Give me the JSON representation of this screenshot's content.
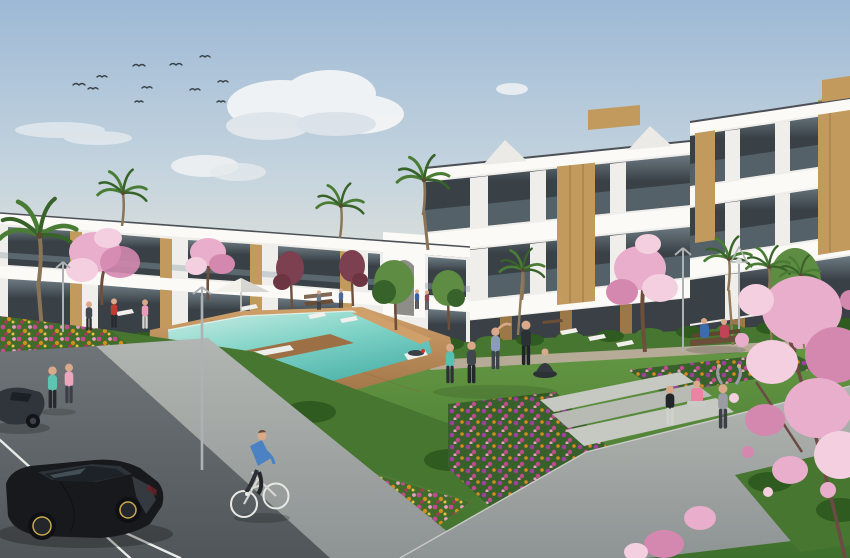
{
  "meta": {
    "type": "architectural-render",
    "subject": "New-build white apartment complex with communal swimming pool, lawns, flower beds, parking and residents outdoors",
    "width_px": 850,
    "height_px": 558
  },
  "colors": {
    "sky_top": "#9db9d5",
    "sky_mid": "#c3d3de",
    "sky_horizon": "#e5e4da",
    "cloud": "#f3f5f6",
    "bird": "#3a4248",
    "building_white": "#f0eeea",
    "building_slab": "#fbfaf7",
    "building_shadow": "#d9d7d2",
    "roof_edge": "#4b5056",
    "glass_dark": "#394147",
    "glass_light": "#6d7a82",
    "wood": "#c29a5e",
    "wood_dark": "#9c7848",
    "lawn_light": "#679a45",
    "lawn_dark": "#3f6f2c",
    "hedge": "#46762f",
    "hedge_dark": "#2f5a20",
    "pool_light": "#cdeee6",
    "pool_mid": "#7fd2c6",
    "pool_deep": "#49b0a8",
    "deck_light": "#cfa06a",
    "deck_dark": "#9c7044",
    "path_light": "#b2b6b2",
    "path_dark": "#8e9494",
    "walkway_light": "#aeb2ae",
    "step": "#c6c8c2",
    "asphalt_light": "#6e7478",
    "asphalt_dark": "#505659",
    "parking_line": "#e9ebe8",
    "car_black": "#17191c",
    "car_black_highlight": "#3c4248",
    "car_gray": "#2f353a",
    "rim_gold": "#c9a94c",
    "blossom": "#e9aecb",
    "blossom_light": "#f4cfe0",
    "blossom_deep": "#d488b0",
    "maroon_tree": "#7c4050",
    "palm_green": "#4a7c36",
    "palm_dark": "#37622a",
    "tree_green": "#5d8c42",
    "trunk": "#6d4f3c",
    "flower_magenta": "#c4498e",
    "flower_orange": "#d8891f",
    "flower_pink": "#e79ec0",
    "flower_red": "#b03558",
    "flower_violet": "#a040a0",
    "flower_yellow": "#e8c048",
    "skin": "#d9a98a",
    "lounger": "#f1f0ec",
    "lamp": "#aeb2b4",
    "bench_wood": "#6b4e38"
  },
  "inventory": {
    "birds": 11,
    "cloud_groups": 4,
    "apartment_wings": 3,
    "palm_trees": 8,
    "pink_blossom_trees": 4,
    "maroon_trees": 2,
    "green_trees": 3,
    "lamp_posts": 4,
    "benches": 3,
    "sun_loungers": 9,
    "parasols": 1,
    "pools": 1,
    "cars": 2,
    "bicycles": 1,
    "people": [
      {
        "label": "walker-teal-top",
        "shirt": "#5ec4b2",
        "pants": "#26292d"
      },
      {
        "label": "walker-pink-top",
        "shirt": "#eba7bd",
        "pants": "#3c4046"
      },
      {
        "label": "poolside-dark-jacket",
        "shirt": "#41484f",
        "pants": "#2a2d31"
      },
      {
        "label": "poolside-red-top",
        "shirt": "#c23b31",
        "pants": "#26292d"
      },
      {
        "label": "poolside-pink-top",
        "shirt": "#ec9cb8",
        "pants": "#d9d5cf"
      },
      {
        "label": "yoga-teal-top",
        "shirt": "#58c0b2",
        "pants": "#2c3036"
      },
      {
        "label": "yoga-dark",
        "shirt": "#40474e",
        "pants": "#23262a"
      },
      {
        "label": "yoga-stretching",
        "shirt": "#8b9cba",
        "pants": "#3c434a"
      },
      {
        "label": "yoga-black",
        "shirt": "#2c3135",
        "pants": "#202327"
      },
      {
        "label": "meditating-seated",
        "shirt": "#32383e",
        "pants": "#2c3136"
      },
      {
        "label": "standing-black-top-white-leggings",
        "shirt": "#232629",
        "pants": "#cfd1cd"
      },
      {
        "label": "sitting-pink-top-on-step",
        "shirt": "#ee82a2",
        "pants": "#c9cbc7"
      },
      {
        "label": "arms-raised-grey-hoodie",
        "shirt": "#9b9ba4",
        "pants": "#3c4046"
      },
      {
        "label": "person-on-sun-lounger",
        "shirt": "#3a4046",
        "pants": "#3a4046"
      },
      {
        "label": "cyclist-blue-shirt",
        "shirt": "#4a82c4",
        "pants": "#2c3136"
      },
      {
        "label": "bench-pair-blue",
        "shirt": "#3e6bb0",
        "pants": "#2a2e33"
      },
      {
        "label": "bench-pair-red",
        "shirt": "#c04458",
        "pants": "#2a2e33"
      },
      {
        "label": "distant-pedestrians",
        "shirt": "#3a60a8",
        "pants": "#8a4a52"
      }
    ]
  }
}
